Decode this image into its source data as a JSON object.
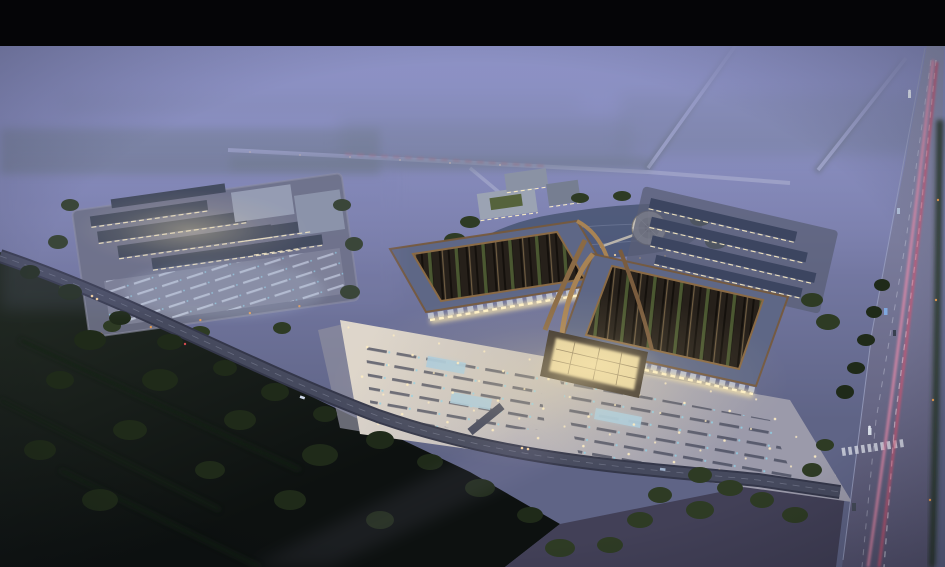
{
  "meta": {
    "type": "architectural-rendering",
    "view": "aerial dusk perspective",
    "description": "Night-time aerial rendering of a large traditional-roofed market complex: twin halls with bronze-trimmed lattice roofs around green courtyards, a lit central gate, an illuminated forecourt plaza with parking rows and fountain pools, a western warehouse complex with parking lot, ponds and a circular fountain plaza behind, eastern warehouse rows, a highway with car light trails on the right, tree belts, dark farmland and fog-covered fields"
  },
  "letterbox": {
    "top_bar_color": "#050507"
  },
  "palette": {
    "sky_top": "#8c91c4",
    "fog_mid": "#797da9",
    "fog_low": "#5f6486",
    "haze_trees": "#50604f",
    "field_dark_top": "#232b24",
    "field_dark_bottom": "#0d1110",
    "tree_dark": "#1f2a19",
    "tree_mid": "#2e3b24",
    "road_distant": "#aeb2cc",
    "road_dark": "#34374a",
    "road_mid": "#4a4d62",
    "highway_top": "#9094b6",
    "highway_bottom": "#55536f",
    "lane_marking": "#d5d8e6",
    "trail_pink": "#f08cab",
    "trail_red": "#d6536f",
    "tail_light_red": "#d24b4f",
    "headlight_warm": "#ffd9a0",
    "plaza_bright": "#ded6cb",
    "plaza_dim": "#9b9aaa",
    "plaza_stall": "#44485a",
    "stall_glow_blue": "#8fd2e8",
    "pool_blue": "#a9cade",
    "plaza_light_dot": "#ffeec4",
    "roof_slate": "#5e6786",
    "roof_bronze": "#8a6a45",
    "roof_bronze_bright": "#a88354",
    "hall_interior": "#26201a",
    "courtyard_green": "#4d5a33",
    "canopy_gray": "#b9c0d2",
    "facade_glow": "#f6e3ab",
    "window_warm": "#fff1c6",
    "left_roof": "#3a4252",
    "left_roof_light": "#99a1b4",
    "left_ground": "#6b6f84",
    "left_parking": "#7e8195",
    "parking_stall_light": "#ccd4e4",
    "pond": "#4d5878",
    "circle_plaza": "#c3beb6",
    "admin_roof": "#9ba3b3",
    "warehouse_roof": "#3c4560",
    "warehouse_ground": "#5a5f75",
    "ground_dusk_purple": "#403e54",
    "lamp_orange": "#f0a050"
  },
  "scene": {
    "landmarks": [
      {
        "id": "twin-market-halls",
        "label": "Twin market halls with lattice roofs and green courtyards"
      },
      {
        "id": "central-gate",
        "label": "Lit central gate pavilion between the halls"
      },
      {
        "id": "forecourt-plaza",
        "label": "Illuminated forecourt plaza with parking rows and fountain pools"
      },
      {
        "id": "west-complex",
        "label": "Western warehouse complex with parking lot"
      },
      {
        "id": "pond-garden",
        "label": "Pond and circular fountain plaza behind the halls"
      },
      {
        "id": "east-warehouses",
        "label": "Eastern warehouse rows"
      },
      {
        "id": "highway",
        "label": "Highway with pink car light trails"
      },
      {
        "id": "access-road",
        "label": "Front access road"
      },
      {
        "id": "tree-belts",
        "label": "Tree belts and dark farmland"
      },
      {
        "id": "foggy-fields",
        "label": "Fog-covered fields with distant roads"
      }
    ]
  }
}
